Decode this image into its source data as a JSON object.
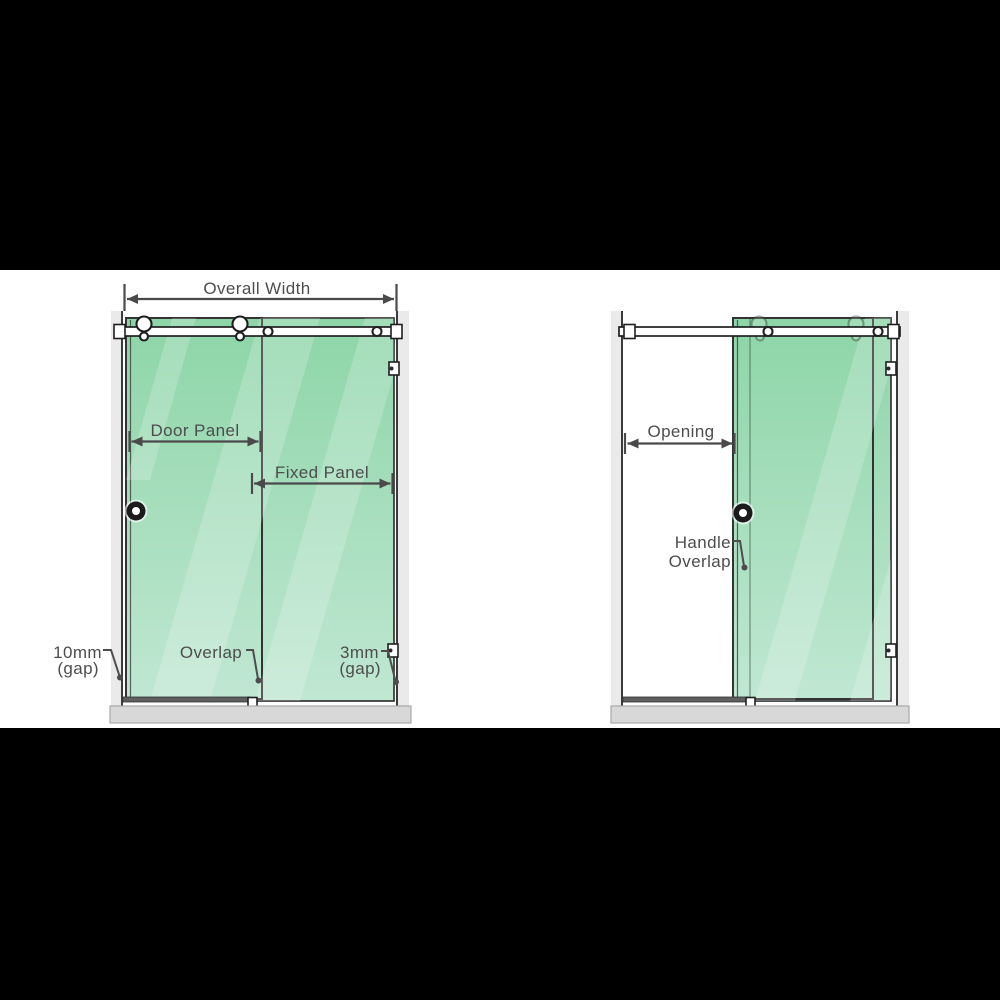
{
  "figure": {
    "type": "product-dimension-diagram",
    "subject": "sliding shower screen front views (closed and open)",
    "background": "#000000",
    "stage_background": "#ffffff"
  },
  "colors": {
    "glass_top": "#8dd5a8",
    "glass_bottom": "#c0e7d2",
    "glass_edge": "#333333",
    "dimension_line": "#4a4a4a",
    "label_text": "#4d4d4d",
    "wall_strip": "#eaeaea",
    "wall_line": "#3b3b3b",
    "floor_fill": "#d8d8d8",
    "hardware_fill": "#ffffff",
    "hardware_stroke": "#1f1f1f"
  },
  "diagram_left": {
    "view": "closed",
    "labels": {
      "overall_width": "Overall Width",
      "door_panel": "Door Panel",
      "fixed_panel": "Fixed Panel",
      "left_gap_value": "10mm",
      "left_gap_unit": "(gap)",
      "overlap": "Overlap",
      "right_gap_value": "3mm",
      "right_gap_unit": "(gap)"
    }
  },
  "diagram_right": {
    "view": "open",
    "labels": {
      "opening": "Opening",
      "handle_overlap_line1": "Handle",
      "handle_overlap_line2": "Overlap"
    }
  }
}
